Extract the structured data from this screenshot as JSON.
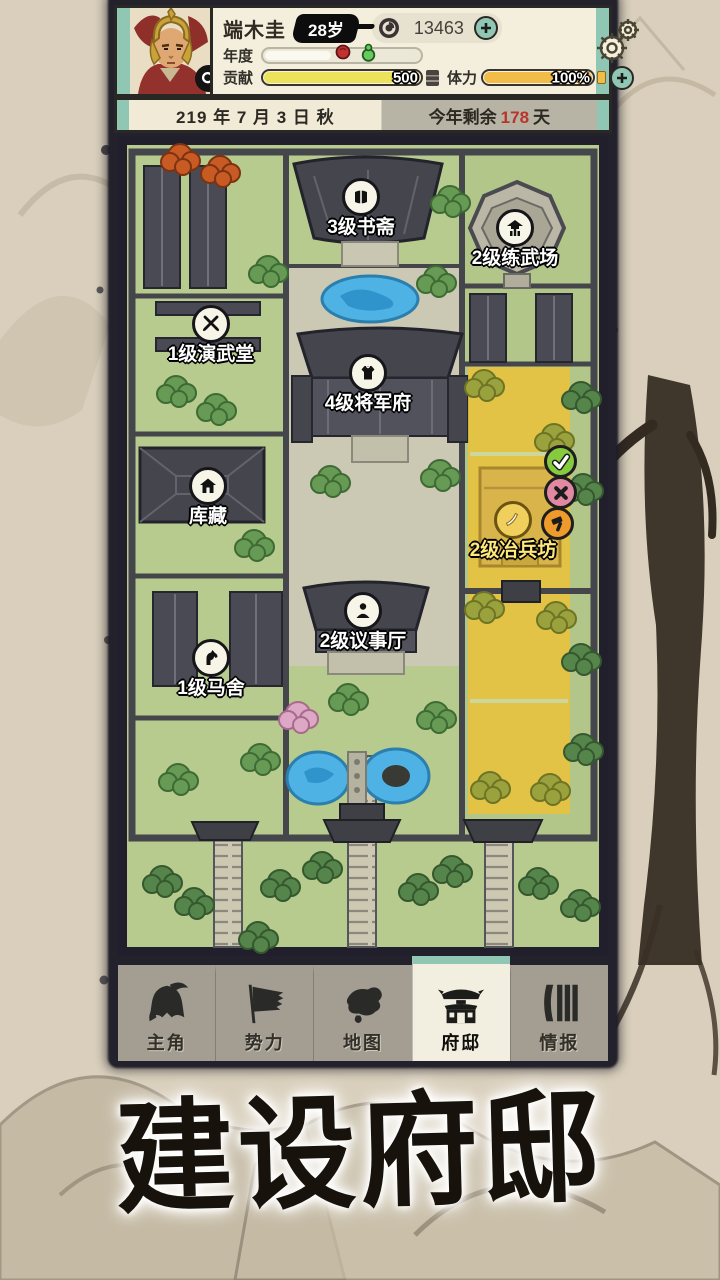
{
  "header": {
    "player": {
      "name": "端木圭",
      "age": "28岁",
      "portrait": "warrior-portrait",
      "magnifier": "magnifier-icon"
    },
    "currency": {
      "icon": "coin-icon",
      "amount": "13463",
      "add_icon": "plus-icon"
    },
    "settings": {
      "icon": "gear-icon"
    },
    "stats": {
      "year": {
        "label": "年度",
        "markers": [
          "red-bead-icon",
          "green-gourd-icon"
        ]
      },
      "contribution": {
        "label": "贡献",
        "value": "500",
        "end_icon": "seal-icon"
      },
      "stamina": {
        "label": "体力",
        "value": "100%",
        "percent": 100,
        "add_icon": "plus-icon"
      }
    }
  },
  "date_bar": {
    "date": "219 年 7 月 3 日 秋",
    "remaining_prefix": "今年剩余",
    "remaining_days": "178",
    "remaining_suffix": "天"
  },
  "map": {
    "buildings": [
      {
        "label": "3级书斋",
        "icon": "book-icon"
      },
      {
        "label": "2级练武场",
        "icon": "pavilion-icon"
      },
      {
        "label": "1级演武堂",
        "icon": "crossed-swords-icon"
      },
      {
        "label": "4级将军府",
        "icon": "armor-icon"
      },
      {
        "label": "库藏",
        "icon": "house-icon"
      },
      {
        "label": "2级冶兵坊",
        "icon": "blade-icon",
        "highlighted": true
      },
      {
        "label": "2级议事厅",
        "icon": "person-icon"
      },
      {
        "label": "1级马舍",
        "icon": "horse-icon"
      }
    ],
    "actions": [
      {
        "name": "confirm",
        "icon": "check-icon",
        "color": "#86ca3e"
      },
      {
        "name": "cancel",
        "icon": "x-icon",
        "color": "#e289a2"
      },
      {
        "name": "build",
        "icon": "hammer-icon",
        "color": "#ef9b2b"
      }
    ]
  },
  "tab_bar": {
    "tabs": [
      {
        "label": "主角",
        "icon": "helmet-icon",
        "active": false
      },
      {
        "label": "势力",
        "icon": "flag-icon",
        "active": false
      },
      {
        "label": "地图",
        "icon": "map-icon",
        "active": false
      },
      {
        "label": "府邸",
        "icon": "mansion-icon",
        "active": true
      },
      {
        "label": "情报",
        "icon": "scrolls-icon",
        "active": false
      }
    ]
  },
  "title_overlay": {
    "text": "建设府邸"
  },
  "colors": {
    "teal_accent": "#8fc7b4",
    "cream_panel": "#f4efdd",
    "paper": "#d9cfbc",
    "bar_yellow": "#ece35a",
    "bar_gold": "#f2bc48",
    "highlight_plot": "#e7c23e",
    "days_red": "#b8352c",
    "map_grass": "#b7cb8e",
    "roof_dark": "#45454e"
  }
}
